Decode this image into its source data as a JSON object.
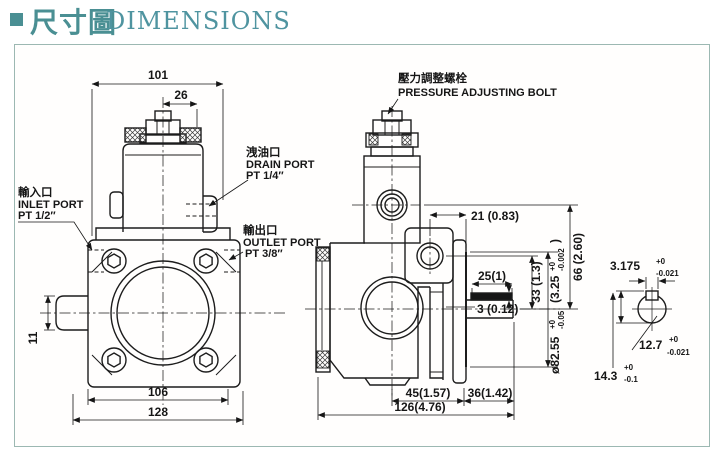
{
  "title": {
    "cjk": "尺寸圖",
    "en": "DIMENSIONS"
  },
  "colors": {
    "accent": "#4a8f93",
    "frame_border": "#9cb8b2",
    "line": "#1c1c1c"
  },
  "front_view": {
    "dims": {
      "mount_face_width": "101",
      "adjust_offset": "26",
      "side_boss_height": "11",
      "bolt_spacing": "106",
      "total_width": "128"
    },
    "ports": {
      "inlet": {
        "cjk": "輸入口",
        "en": "INLET PORT",
        "thread": "PT 1/2″"
      },
      "outlet": {
        "cjk": "輸出口",
        "en": "OUTLET PORT",
        "thread": "PT 3/8″"
      },
      "drain": {
        "cjk": "洩油口",
        "en": "DRAIN PORT",
        "thread": "PT 1/4″"
      }
    }
  },
  "side_view": {
    "pressure_bolt": {
      "cjk": "壓力調整螺栓",
      "en": "PRESSURE ADJUSTING BOLT"
    },
    "dims": {
      "port_center": "21 (0.83)",
      "key_length": "25(1)",
      "key_height": "3 (0.12)",
      "shaft_center": "33 (1.3)",
      "center_height": "66 (2.60)",
      "body_length": "45(1.57)",
      "shaft_length": "36(1.42)",
      "total_length": "126(4.76)",
      "spigot": {
        "mm": "ø82.55",
        "mm_plus": "+0",
        "mm_minus": "-0.05",
        "inch": "(3.25",
        "inch_plus": "+0",
        "inch_minus": "-0.002",
        "close": ")"
      }
    }
  },
  "shaft_detail": {
    "key_width": {
      "val": "3.175",
      "plus": "+0",
      "minus": "-0.021"
    },
    "diameter": {
      "val": "12.7",
      "plus": "+0",
      "minus": "-0.021"
    },
    "height": {
      "val": "14.3",
      "plus": "+0",
      "minus": "-0.1"
    }
  }
}
